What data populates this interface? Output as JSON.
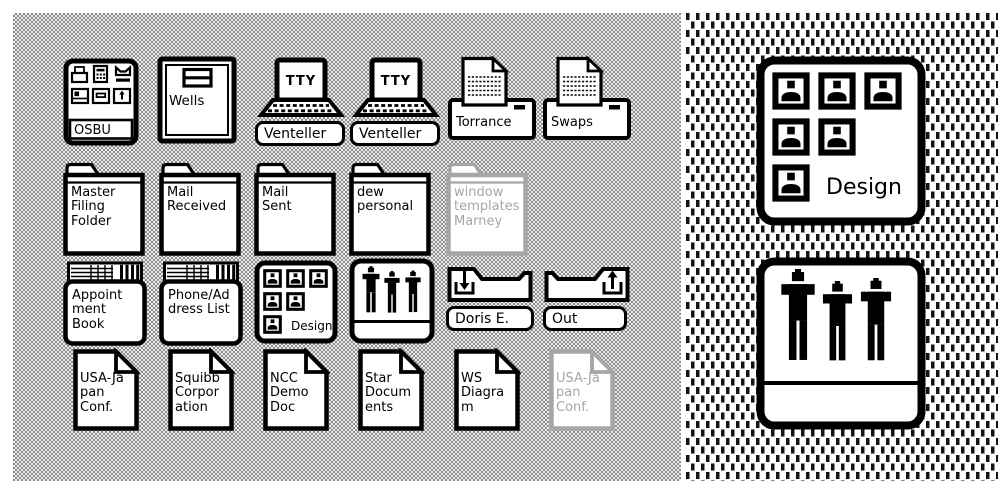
{
  "colors": {
    "ink": "#000000",
    "paper": "#ffffff",
    "ghost_gray": "#a6a6a6",
    "desktop_dither_dark": "#8e8e8e",
    "desktop_dither_light": "#ececec"
  },
  "left_desktop": {
    "osbu": {
      "label": "OSBU"
    },
    "wells": {
      "label": "Wells"
    },
    "venteller1": {
      "screen": "TTY",
      "label": "Venteller"
    },
    "venteller2": {
      "screen": "TTY",
      "label": "Venteller"
    },
    "torrance": {
      "label": "Torrance"
    },
    "swaps": {
      "label": "Swaps"
    },
    "folders": [
      {
        "label": "Master\nFiling\nFolder"
      },
      {
        "label": "Mail\nReceived"
      },
      {
        "label": "Mail\nSent"
      },
      {
        "label": "dew\npersonal"
      },
      {
        "label": "window\ntemplates\nMarney"
      }
    ],
    "appointment_book": {
      "label": "Appoint\nment\nBook"
    },
    "phone_address_list": {
      "label": "Phone/Ad\ndress List"
    },
    "design_group": {
      "label": "Design"
    },
    "people_group": {
      "label": ""
    },
    "in_tray": {
      "label": "Doris E."
    },
    "out_tray": {
      "label": "Out"
    },
    "documents": [
      {
        "label": "USA-Ja\npan\nConf."
      },
      {
        "label": "Squibb\nCorpor\nation"
      },
      {
        "label": "NCC\nDemo\nDoc"
      },
      {
        "label": "Star\nDocum\nents"
      },
      {
        "label": "WS\nDiagra\nm"
      },
      {
        "label": "USA-Ja\npan\nConf."
      }
    ]
  },
  "right_panel": {
    "design_group": {
      "label": "Design"
    },
    "people_group": {
      "label": ""
    }
  }
}
